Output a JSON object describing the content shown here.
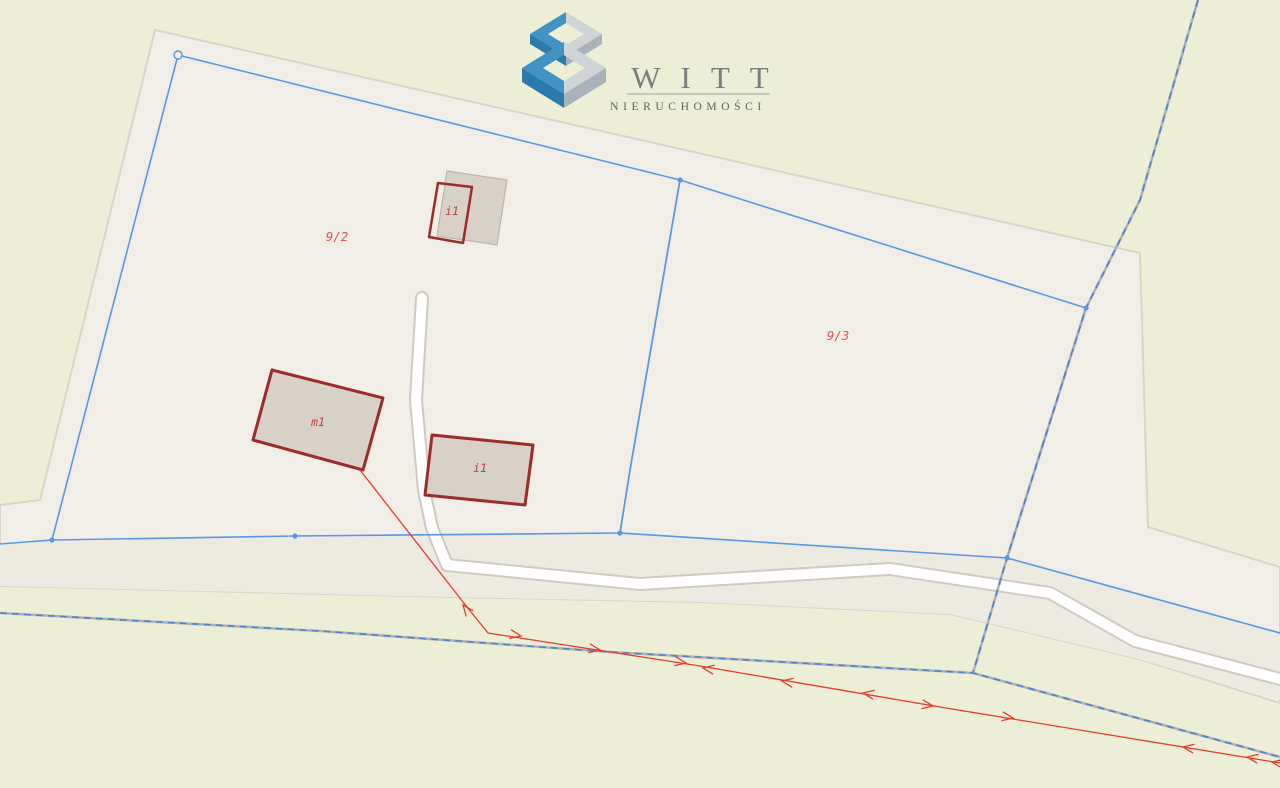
{
  "logo": {
    "title": "WITT",
    "subtitle": "NIERUCHOMOŚCI"
  },
  "labels": {
    "parcel_92": "9/2",
    "parcel_93": "9/3",
    "building_top": "i1",
    "building_m1": "m1",
    "building_mid": "i1"
  },
  "theme": {
    "bg_green": "#ecefd6",
    "parcel_beige": "#f1eee7",
    "road_corridor": "#edeae2",
    "road_white": "#ffffff",
    "road_casing": "#cfcabf",
    "area_border": "#d9d4c9",
    "blue_line": "#5c97e2",
    "dashed_blue": "#4b83d6",
    "dashed_gray": "#a8a8a8",
    "building_fill": "#d7d1c8",
    "building_stroke": "#9d2b2b",
    "building_gray_stroke": "#bcb6aa",
    "label_red": "#e25252",
    "building_label_red": "#bf4343",
    "utility_red": "#e63a2e",
    "logo_blue_light": "#4292c4",
    "logo_blue_dark": "#2a7aae",
    "logo_gray_light": "#ced4d7",
    "logo_gray_dark": "#a9b2b8",
    "logo_text": "#7d7d7d",
    "logo_subtext": "#5f5f5f",
    "logo_line": "#a0a0a0"
  },
  "geometry": {
    "area_beige": "155,30 1140,253 1148,527 1280,567 1280,703 1135,658 950,614 700,602 450,597 0,586 0,505 40,500",
    "road_corridor": "0,544 52,540 295,536 620,533 1007,558 1280,633 1280,700 1135,658 950,614 700,602 450,597 0,586",
    "road_path": "422,298 416,400 424,490 432,528 447,565 640,584 890,569 1050,593 1135,641 1280,679",
    "parcel_92": "178,55 680,180 630,470 620,533 295,536 52,540",
    "parcel_93": "680,180 1086,308 1007,558 620,533 630,470",
    "boundary_left_ext": "52,540 0,544",
    "boundary_right_ext": "1007,558 1280,633",
    "dashed_ne": "1198,0 1140,200 1086,308 1007,558 973,673",
    "dashed_south": "0,613 320,631 610,652 973,673 1280,757",
    "building_gray": "447,171 507,180 497,245 437,236",
    "building_i1_top": "438,183 472,187 463,243 429,237",
    "building_m1": "272,370 383,398 363,470 253,440",
    "building_i1_mid": "432,435 533,445 525,505 425,495",
    "utility_line": "360,470 463,602 488,633 610,652 700,666 940,707 1280,763",
    "cube_top_ring_left": "566,12 530,34 566,56 566,45 548,34 566,23",
    "cube_top_ring_right": "566,12 602,34 566,56 566,45 584,34 566,23",
    "cube_top_skirt_left": "530,34 566,56 566,66 530,44",
    "cube_top_skirt_right": "566,56 602,34 602,44 566,66",
    "cube_bottom_ring_left": "564,42 522,68 564,94 564,81 543,68 564,55",
    "cube_bottom_ring_right": "564,42 606,68 564,94 564,81 585,68 564,55",
    "cube_bottom_skirt_left": "522,68 564,94 564,108 522,82",
    "cube_bottom_skirt_right": "564,94 606,68 606,82 564,108"
  },
  "vertices": [
    {
      "x": 178,
      "y": 55,
      "open": true
    },
    {
      "x": 52,
      "y": 540
    },
    {
      "x": 295,
      "y": 536
    },
    {
      "x": 620,
      "y": 533
    },
    {
      "x": 680,
      "y": 180
    },
    {
      "x": 1086,
      "y": 308
    },
    {
      "x": 1007,
      "y": 558
    }
  ],
  "utility_arrows": [
    {
      "x": 463,
      "y": 605,
      "a": 232
    },
    {
      "x": 521,
      "y": 636,
      "a": 10
    },
    {
      "x": 600,
      "y": 650,
      "a": 9
    },
    {
      "x": 686,
      "y": 663,
      "a": 9
    },
    {
      "x": 703,
      "y": 668,
      "a": 189
    },
    {
      "x": 782,
      "y": 681,
      "a": 189
    },
    {
      "x": 863,
      "y": 693,
      "a": 189
    },
    {
      "x": 933,
      "y": 706,
      "a": 9
    },
    {
      "x": 1013,
      "y": 718,
      "a": 9
    },
    {
      "x": 1183,
      "y": 747,
      "a": 189
    },
    {
      "x": 1247,
      "y": 757,
      "a": 189
    },
    {
      "x": 1272,
      "y": 762,
      "a": 189
    }
  ]
}
